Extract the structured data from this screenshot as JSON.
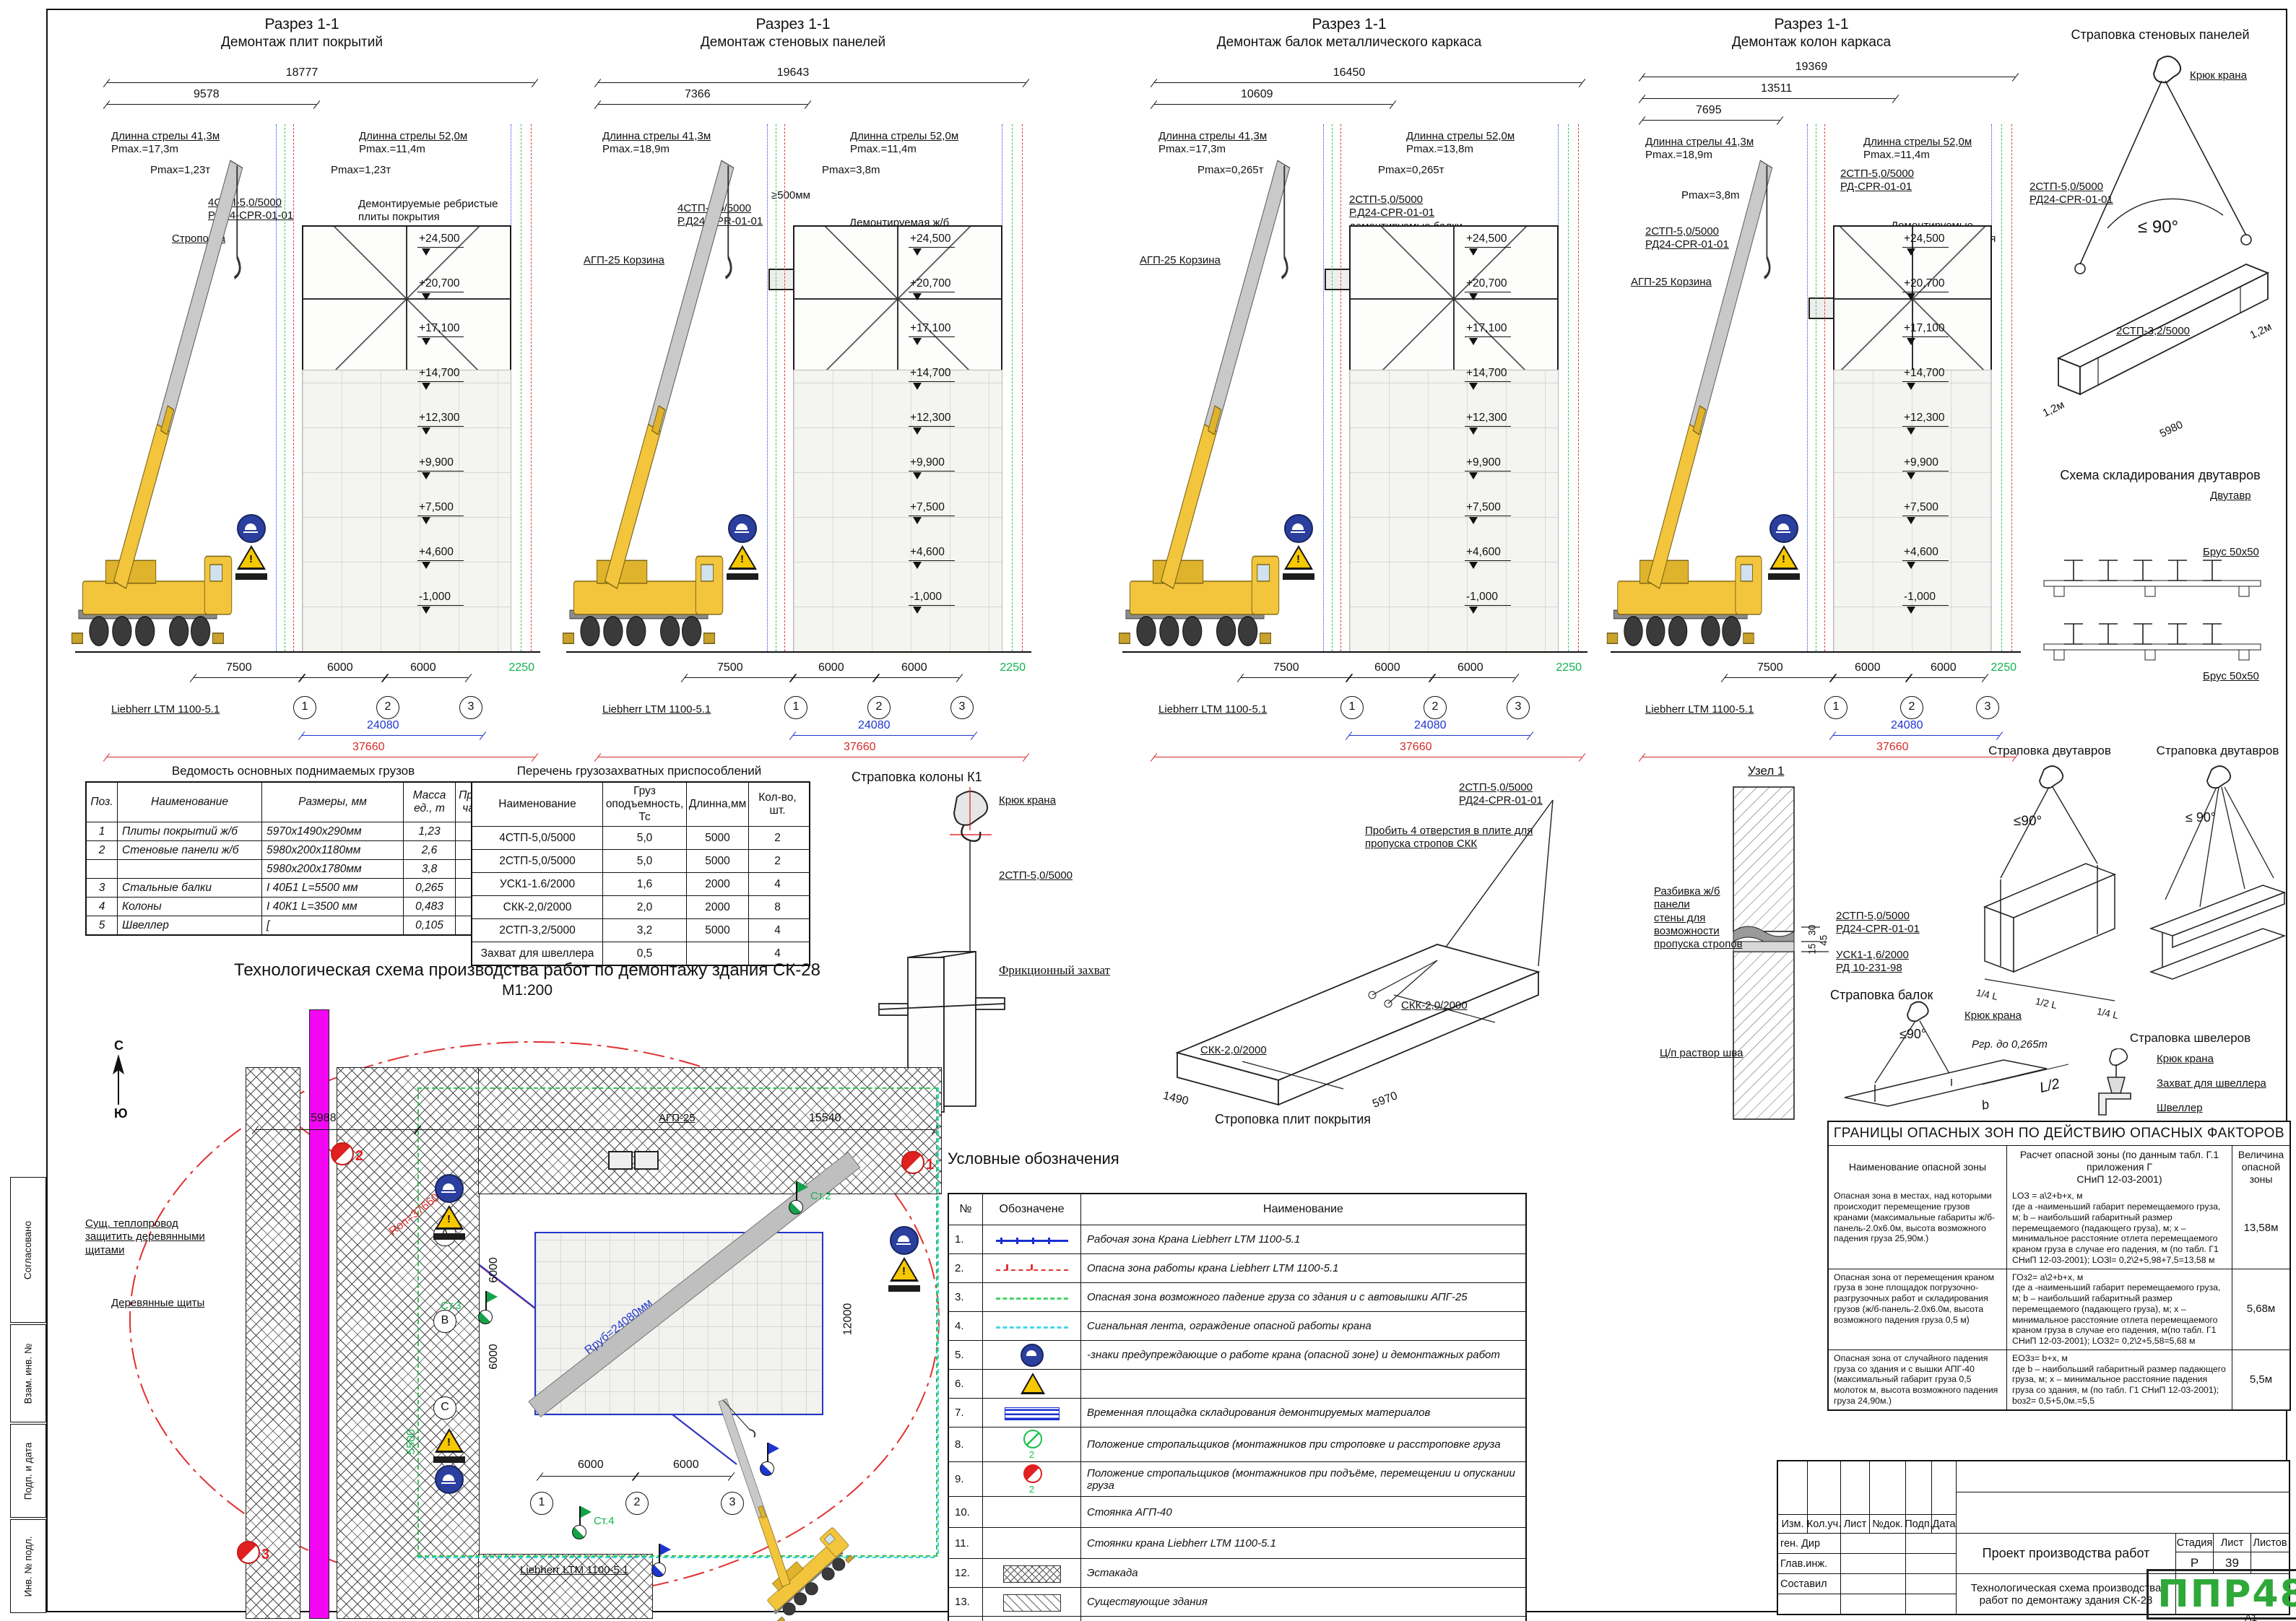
{
  "sheet": {
    "format": "А1"
  },
  "frame": {
    "left_labels": [
      "Согласовано",
      "Взам. инв. №",
      "Подп. и дата",
      "Инв. № подл."
    ]
  },
  "elevations": [
    "+24,500",
    "+20,700",
    "+17,100",
    "+14,700",
    "+12,300",
    "+9,900",
    "+7,500",
    "+4,600",
    "-1,000"
  ],
  "bottom": {
    "d1": "7500",
    "d2": "6000",
    "d3": "6000",
    "side": "2250",
    "total_blue": "24080",
    "total_red": "37660",
    "axes": [
      "1",
      "2",
      "3"
    ]
  },
  "sections": [
    {
      "title1": "Разрез 1-1",
      "title2": "Демонтаж плит покрытий",
      "dim1": "18777",
      "dim2": "9578",
      "dim3": "",
      "boom_left1": "Длинна стрелы 41,3м",
      "boom_left2": "Pmax.=17,3m",
      "boom_right1": "Длинна стрелы 52,0м",
      "boom_right2": "Pmax.=11,4m",
      "c1": "Pmax=1,23т",
      "c2": "Pmax=1,23т",
      "c3": "4СТП-5,0/5000\nР.Д24-СРR-01-01",
      "c4": "Строповка",
      "c5": "Демонтируемые ребристые\nплиты покрытия",
      "crane": "Liebherr LTM 1100-5.1"
    },
    {
      "title1": "Разрез 1-1",
      "title2": "Демонтаж стеновых панелей",
      "dim1": "19643",
      "dim2": "7366",
      "dim3": "",
      "boom_left1": "Длинна стрелы 41,3м",
      "boom_left2": "Pmax.=18,9m",
      "boom_right1": "Длинна стрелы 52,0м",
      "boom_right2": "Pmax.=11,4m",
      "c1": "Pmax=3,8m",
      "c2": "≥500мм",
      "c3": "4СТП-5,0/5000\nР.Д24-СРR-01-01",
      "c4": "АГП-25 Корзина",
      "c5": "Демонтируемая ж/б\nпанель стены",
      "crane": "Liebherr LTM 1100-5.1"
    },
    {
      "title1": "Разрез 1-1",
      "title2": "Демонтаж балок металлического каркаса",
      "dim1": "16450",
      "dim2": "10609",
      "dim3": "",
      "boom_left1": "Длинна стрелы 41,3м",
      "boom_left2": "Pmax.=17,3m",
      "boom_right1": "Длинна стрелы 52,0м",
      "boom_right2": "Pmax.=13,8m",
      "c1": "Pmax=0,265т",
      "c2": "Pmax=0,265т",
      "c3": "2СТП-5,0/5000\nР.Д24-СРR-01-01\nдемонтируемые балки\nиз профиля",
      "c4": "АГП-25 Корзина",
      "c5": "",
      "crane": "Liebherr LTM 1100-5.1"
    },
    {
      "title1": "Разрез 1-1",
      "title2": "Демонтаж колон каркаса",
      "dim1": "19369",
      "dim2": "13511",
      "dim3": "7695",
      "boom_left1": "Длинна стрелы 41,3м",
      "boom_left2": "Pmax.=18,9m",
      "boom_mid1": "Длинна стрелы 41,3м",
      "boom_mid2": "Pmax.=14,9m",
      "boom_right1": "Длинна стрелы 52,0м",
      "boom_right2": "Pmax.=11,4m",
      "c1": "Pmax=3,8m",
      "c2": "2СТП-5,0/5000\nРД-СРR-01-01",
      "c3": "2СТП-5,0/5000\nРД24-СРR-01-01",
      "c4": "АГП-25 Корзина",
      "c5": "Демонтируемые\nколонны из профиля",
      "crane": "Liebherr LTM 1100-5.1"
    }
  ],
  "tables": {
    "loads": {
      "title": "Ведомость основных поднимаемых грузов",
      "headers": [
        "Поз.",
        "Наименование",
        "Размеры, мм",
        "Масса ед., т",
        "Приме-\nчание"
      ],
      "rows": [
        [
          "1",
          "Плиты покрытий ж/б",
          "5970х1490х290мм",
          "1,23",
          ""
        ],
        [
          "2",
          "Стеновые панели ж/б",
          "5980х200х1180мм",
          "2,6",
          ""
        ],
        [
          "",
          "",
          "5980х200х1780мм",
          "3,8",
          ""
        ],
        [
          "3",
          "Стальные балки",
          "I 40Б1   L=5500 мм",
          "0,265",
          ""
        ],
        [
          "4",
          "Колоны",
          "I 40К1   L=3500 мм",
          "0,483",
          ""
        ],
        [
          "5",
          "Швеллер",
          "[",
          "0,105",
          ""
        ]
      ]
    },
    "rigging": {
      "title": "Перечень грузозахватных приспособлений",
      "headers": [
        "Наименование",
        "Груз\nоподъемность,\nТс",
        "Длинна,мм",
        "Кол-во, шт."
      ],
      "rows": [
        [
          "4СТП-5,0/5000",
          "5,0",
          "5000",
          "2"
        ],
        [
          "2СТП-5,0/5000",
          "5,0",
          "5000",
          "2"
        ],
        [
          "УСК1-1.6/2000",
          "1,6",
          "2000",
          "4"
        ],
        [
          "СКК-2,0/2000",
          "2,0",
          "2000",
          "8"
        ],
        [
          "2СТП-3,2/5000",
          "3,2",
          "5000",
          "4"
        ],
        [
          "Захват для швеллера",
          "0,5",
          "",
          "4"
        ]
      ]
    }
  },
  "details": {
    "wall_panel": {
      "title": "Страповка стеновых панелей",
      "hook": "Крюк крана",
      "sling1": "2СТП-5,0/5000\nРД24-CPR-01-01",
      "angle": "≤ 90°",
      "sling2": "2СТП-3,2/5000",
      "dim_len": "5980",
      "off1": "1,2м",
      "off2": "1,2м"
    },
    "storage": {
      "title": "Схема складирования двутавров",
      "item": "Двутавр",
      "bar1": "Брус 50х50",
      "bar2": "Брус 50х50"
    },
    "ibeam1": {
      "title": "Страповка двутавров",
      "angle": "≤90°",
      "dimA": "1/4 L",
      "dimB": "1/2 L",
      "dimC": "1/4 L"
    },
    "ibeam2": {
      "title": "Страповка двутавров",
      "angle": "≤ 90°"
    },
    "beams": {
      "title": "Страповка балок",
      "hook": "Крюк крана",
      "sling1": "2СТП-5,0/5000\nРД24-СРR-01-01",
      "sling2": "УСК1-1,6/2000\nРД 10-231-98",
      "load": "Ргр. до 0,265m",
      "angle": "≤90°",
      "dim1": "L/2",
      "dim2": "b"
    },
    "channel": {
      "title": "Страповка швелеров",
      "hook": "Крюк крана",
      "grab": "Захват для швеллера",
      "item": "Швеллер"
    },
    "column_k1": {
      "title": "Страповка колоны К1",
      "hook": "Крюк крана",
      "sling": "2СТП-5,0/5000",
      "grab": "Фрикционный захват"
    },
    "slab": {
      "title": "Строповка плит покрытия",
      "sling_top": "2СТП-5,0/5000\nРД24-СРR-01-01",
      "note": "Пробить 4 отверстия в плите для\nпропуска стропов СКК",
      "skk1": "СКК-2,0/2000",
      "skk2": "СКК-2,0/2000",
      "dim_l": "5970",
      "dim_w": "1490"
    },
    "node1": {
      "title": "Узел 1",
      "note1": "Разбивка ж/б панели\nстены для возможности\nпропуска стропов",
      "note2": "Ц/п раствор шва",
      "d1": "30",
      "d2": "15",
      "d3": "45"
    }
  },
  "site_plan": {
    "title": "Технологическая схема производства работ по демонтажу здания СК-28",
    "scale": "М1:200",
    "north_n": "С",
    "north_s": "Ю",
    "heat_note": "Сущ. теплопровод\nзащитить деревянными\nщитами",
    "shields": "Деревянные щиты",
    "agp": "АГП-25",
    "crane": "Liebherr LTM 1100-5.1",
    "rop": "Rоп=37660мм",
    "rrub": "Rруб=24080мм",
    "d5988": "5988",
    "d15540": "15540",
    "d5500": "5500",
    "d12000": "12000",
    "d6000": "6000",
    "row_axes": [
      "А",
      "В",
      "С"
    ],
    "col_axes": [
      "1",
      "2",
      "3"
    ],
    "stands": [
      "Ст.2",
      "Ст.3",
      "Ст.4"
    ],
    "pos": [
      "1",
      "2",
      "3"
    ]
  },
  "legend": {
    "title": "Условные обозначения",
    "headers": [
      "№",
      "Обозначене",
      "Наименование"
    ],
    "rows": [
      {
        "num": "1.",
        "sym": "line-blue",
        "sub": "",
        "label": "Рабочая зона Крана Liebherr LTM 1100-5.1"
      },
      {
        "num": "2.",
        "sym": "line-red",
        "sub": "",
        "label": "Опасна зона работы крана  Liebherr LTM 1100-5.1"
      },
      {
        "num": "3.",
        "sym": "dash-green",
        "sub": "",
        "label": "Опасная зона возможного падение груза со здания и с автовышки АПГ-25"
      },
      {
        "num": "4.",
        "sym": "dash-cyan",
        "sub": "",
        "label": "Сигнальная лента, ограждение опасной работы крана"
      },
      {
        "num": "5.",
        "sym": "sign-blue",
        "sub": "",
        "label": "-знаки предупреждающие о работе крана (опасной зоне) и демонтажных работ"
      },
      {
        "num": "6.",
        "sym": "sign-warn",
        "sub": "",
        "label": ""
      },
      {
        "num": "7.",
        "sym": "pad-blue",
        "sub": "",
        "label": "Временная площадка складирования демонтируемых материалов"
      },
      {
        "num": "8.",
        "sym": "pos-green",
        "sub": "2",
        "label": "Положение стропальщиков (монтажников  при    строповке и расстроповке груза"
      },
      {
        "num": "9.",
        "sym": "pos-red",
        "sub": "2",
        "label": "Положение стропальщиков (монтажников  при подъёме, перемещении и опускании груза"
      },
      {
        "num": "10.",
        "sym": "flag-green",
        "sub": "",
        "label": "Стоянка АГП-40"
      },
      {
        "num": "11.",
        "sym": "flag-blue",
        "sub": "",
        "label": "Стоянки крана Liebherr LTM 1100-5.1"
      },
      {
        "num": "12.",
        "sym": "hatch-cross",
        "sub": "",
        "label": "Эстакада"
      },
      {
        "num": "13.",
        "sym": "hatch-diag",
        "sub": "",
        "label": "Существующие здания"
      },
      {
        "num": "14.",
        "sym": "fill-magenta",
        "sub": "",
        "label": "Существующий теплопровод"
      }
    ]
  },
  "danger": {
    "title": "ГРАНИЦЫ ОПАСНЫХ ЗОН ПО ДЕЙСТВИЮ ОПАСНЫХ ФАКТОРОВ",
    "headers": [
      "Наименование опасной зоны",
      "Расчет опасной зоны (по данным табл. Г.1\nприложения Г\nСНиП 12-03-2001)",
      "Величина\nопасной зоны"
    ],
    "rows": [
      {
        "zone": "Опасная зона в местах, над которыми происходит перемещение грузов кранами (максимальные габариты ж/б-панель-2.0х6.0м, высота возможного падения груза 25,90м.)",
        "calc": "LОЗ = a\\2+b+х, м\nгде а -наименьший габарит перемещаемого груза, м; b – наибольший габаритный размер перемещаемого (падающего груза), м; х – минимальное расстояние отлета перемещаемого краном груза в случае его падения, м (по табл. Г1 СНиП 12-03-2001); LОЗl= 0,2\\2+5,98+7,5=13,58 м",
        "value": "13,58м"
      },
      {
        "zone": "Опасная зона от перемещения краном груза в зоне площадок погрузочно-разгрузочных работ и складирования грузов (ж/б-панель-2.0х6.0м, высота возможного падения груза 0,5 м)",
        "calc": "ГОз2= a\\2+b+х, м\nгде а -наименьший габарит перемещаемого груза, м; b – наибольший габаритный размер перемещаемого (падающего груза), м; х – минимальное расстояние отлета перемещаемого краном груза в случае его падения, м(по табл. Г1 СНиП 12-03-2001); LОЗ2= 0,2\\2+5,58=5,68 м",
        "value": "5,68м"
      },
      {
        "zone": "Опасная зона от случайного падения груза со здания и с вышки АПГ-40 (максимальный габарит груза 0,5 молоток м, высота возможного падения груза 24,90м.)",
        "calc": "ЕОЗз= b+х, м\nгде b – наибольший габаритный размер падающего груза, м; х – минимальное расстояние падения груза со здания, м (по табл. Г1 СНиП 12-03-2001); bоз2= 0,5+5,0м.=5,5",
        "value": "5,5м"
      }
    ]
  },
  "title_block": {
    "header_cells": [
      "Изм.",
      "Кол.уч.",
      "Лист",
      "№док.",
      "Подп.",
      "Дата"
    ],
    "org_rows": [
      "ген. Дир",
      "Глав.инж.",
      "Составил"
    ],
    "project": "Проект производства работ",
    "stage_label": "Стадия",
    "sheet_label": "Лист",
    "sheets_label": "Листов",
    "stage": "Р",
    "sheet": "39",
    "sheets": "",
    "doc_title": "Технологическая схема производства\nработ по демонтажу здания СК-28",
    "logo": "ППР48",
    "format": "А1"
  }
}
